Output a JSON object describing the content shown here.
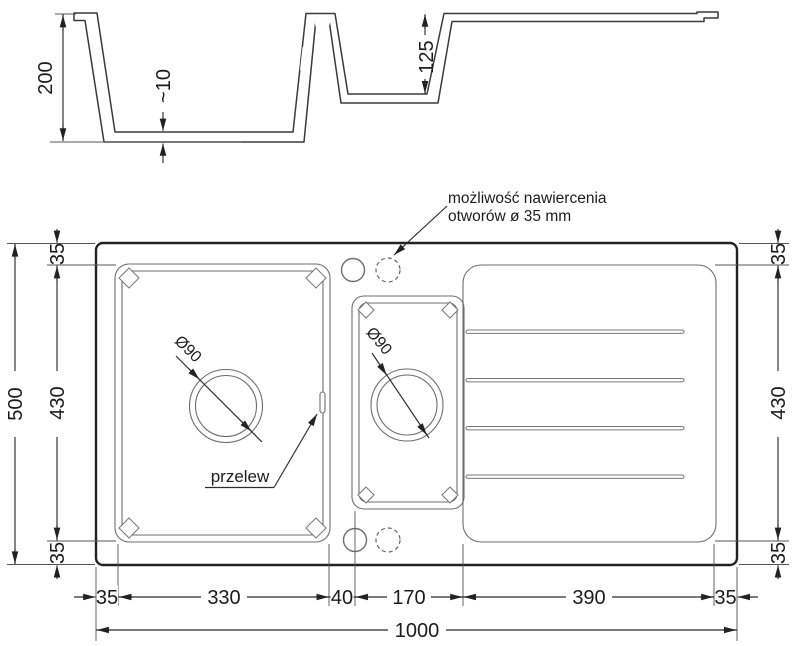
{
  "section": {
    "depth_total": "200",
    "bottom_thickness": "~10",
    "small_bowl_depth": "125"
  },
  "plan": {
    "annotation": {
      "line1": "możliwość nawiercenia",
      "line2": "otworów ø 35 mm"
    },
    "overflow_label": "przelew",
    "main_drain_label": "Ø90",
    "small_drain_label": "Ø90",
    "left": {
      "total": "500",
      "top": "35",
      "middle": "430",
      "bottom": "35"
    },
    "right": {
      "top": "35",
      "middle": "430",
      "bottom": "35"
    },
    "bottom": {
      "seg0": "35",
      "seg1": "330",
      "seg2": "40",
      "seg3": "170",
      "seg4": "390",
      "seg5": "35",
      "total": "1000"
    }
  }
}
